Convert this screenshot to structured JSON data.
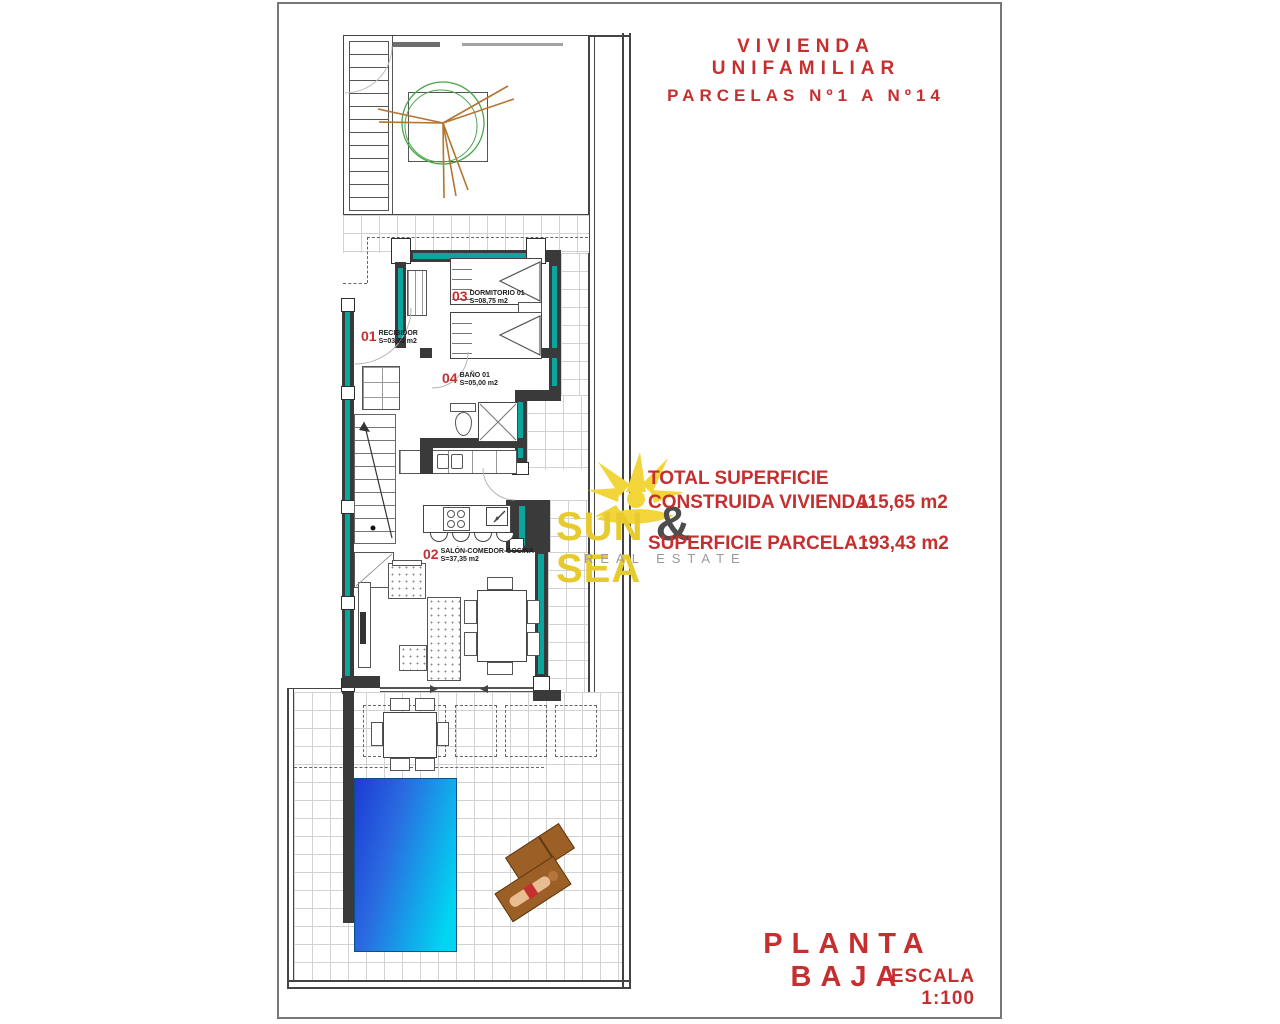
{
  "header": {
    "title_line1": "VIVIENDA UNIFAMILIAR",
    "title_line2": "PARCELAS Nº1 A Nº14"
  },
  "summary": {
    "label_line1": "TOTAL SUPERFICIE",
    "label_line2": "CONSTRUIDA VIVIENDA:",
    "built_area": "115,65 m2",
    "plot_label": "SUPERFICIE PARCELA :",
    "plot_area": "193,43 m2"
  },
  "footer": {
    "plan_name": "PLANTA BAJA",
    "scale": "ESCALA 1:100"
  },
  "logo": {
    "word1": "SUN",
    "amp": "&",
    "word2": "SEA",
    "tagline": "REAL ESTATE"
  },
  "rooms": [
    {
      "number": "01",
      "name": "RECIBIDOR",
      "area": "S=03,80 m2"
    },
    {
      "number": "02",
      "name": "SALÓN-COMEDOR-COCINA",
      "area": "S=37,35 m2"
    },
    {
      "number": "03",
      "name": "DORMITORIO 01",
      "area": "S=08,75 m2"
    },
    {
      "number": "04",
      "name": "BAÑO 01",
      "area": "S=05,00 m2"
    }
  ],
  "colors": {
    "accent_red": "#C62F2F",
    "wall": "#3A3A3A",
    "glazing_teal": "#0AA69E",
    "pool_start": "#1C3BD4",
    "pool_end": "#00D6F2",
    "logo_yellow": "#E7CB2E",
    "logo_gray": "#9A9A9A"
  }
}
